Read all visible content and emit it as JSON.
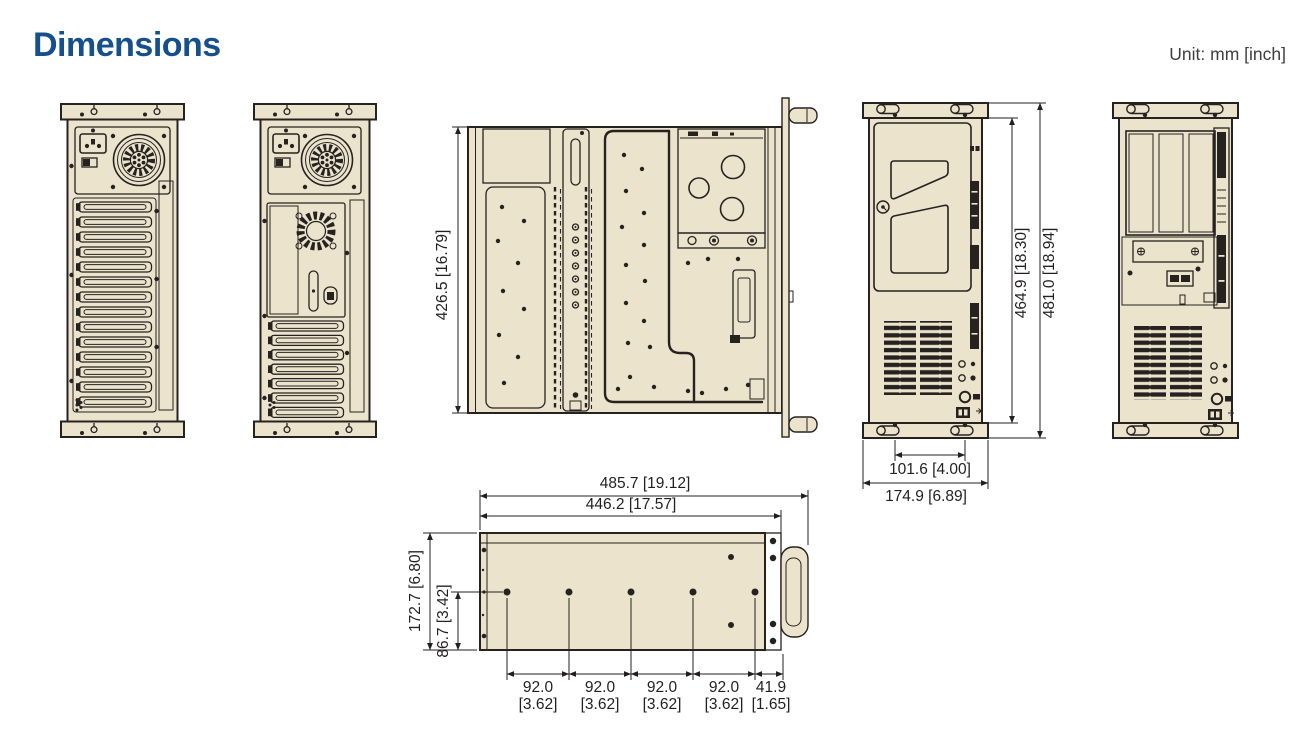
{
  "header": {
    "title": "Dimensions",
    "unit_label": "Unit: mm [inch]"
  },
  "dims": {
    "top_depth": "426.5 [16.79]",
    "front_inner_height": "464.9 [18.30]",
    "front_total_height": "481.0 [18.94]",
    "handle_hole_spacing": "101.6 [4.00]",
    "front_width": "174.9 [6.89]",
    "bottom_total_length": "485.7 [19.12]",
    "bottom_body_length": "446.2 [17.57]",
    "bottom_total_width": "172.7 [6.80]",
    "bottom_hole_offset": "86.7 [3.42]",
    "spacings": [
      {
        "mm": "92.0",
        "inch": "[3.62]"
      },
      {
        "mm": "92.0",
        "inch": "[3.62]"
      },
      {
        "mm": "92.0",
        "inch": "[3.62]"
      },
      {
        "mm": "92.0",
        "inch": "[3.62]"
      },
      {
        "mm": "41.9",
        "inch": "[1.65]"
      }
    ]
  },
  "colors": {
    "accent": "#15508C",
    "chassis_fill": "#ECE3CD",
    "line": "#262220",
    "dim_text": "#231F20"
  }
}
